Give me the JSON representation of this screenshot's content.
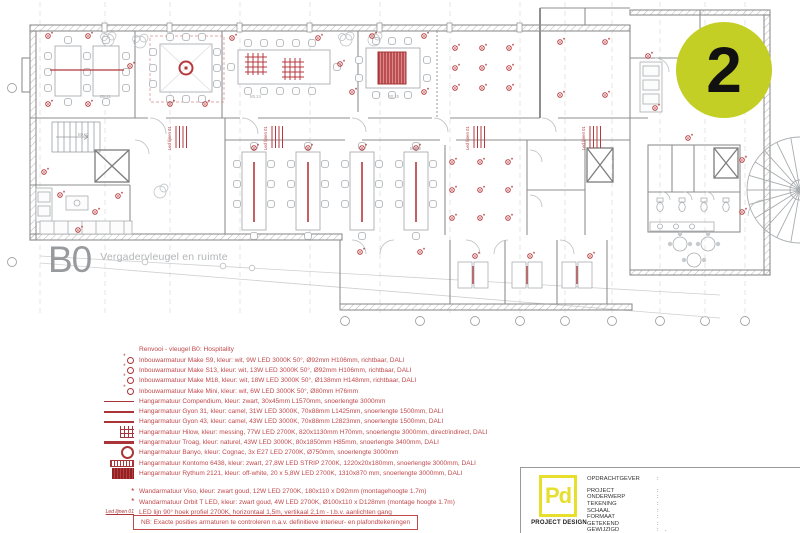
{
  "badge": {
    "number": "2"
  },
  "plan": {
    "sheet_code": "B0",
    "sheet_title": "Vergadervleugel en ruimte",
    "led_label": "Led lijnen 01",
    "room_labels": [
      "B0.21",
      "B0.24",
      "B0.25",
      "B0.13",
      "B0.30",
      "B0.02"
    ]
  },
  "legend": {
    "header": "Renvooi - vleugel B0: Hospitality",
    "items": [
      {
        "icon": "downlight-marker",
        "text": "Inbouwarmatuur Make S9, kleur: wit, 9W LED 3000K 50°, Ø92mm H106mm, richtbaar, DALI"
      },
      {
        "icon": "downlight-marker",
        "text": "Inbouwarmatuur Make S13, kleur: wit, 13W LED 3000K 50°, Ø92mm H106mm, richtbaar, DALI"
      },
      {
        "icon": "downlight-marker",
        "text": "Inbouwarmatuur Make M18, kleur: wit, 18W LED 3000K 50°, Ø138mm H148mm, richtbaar, DALI"
      },
      {
        "icon": "downlight-marker",
        "text": "Inbouwarmatuur Make Mini, kleur: wit, 6W LED 3000K 50°, Ø80mm H76mm"
      },
      {
        "icon": "pendant-line-thin",
        "text": "Hangarmatuur Compendium, kleur: zwart, 30x45mm L1570mm, snoerlengte 3000mm"
      },
      {
        "icon": "pendant-line-medium",
        "text": "Hangarmatuur Gyon 31, kleur: camel, 31W LED 3000K, 70x88mm L1425mm, snoerlengte 1500mm, DALI"
      },
      {
        "icon": "pendant-line-medium",
        "text": "Hangarmatuur Gyon 43, kleur: camel, 43W LED 3000K, 70x88mm L2823mm, snoerlengte 1500mm, DALI"
      },
      {
        "icon": "grid-hash",
        "text": "Hangarmatuur Hilow, kleur: messing, 77W LED 2700K, 820x1130mm H70mm, snoerlengte 3000mm, direct/indirect, DALI"
      },
      {
        "icon": "pendant-line-thick",
        "text": "Hangarmatuur Troag, kleur: naturel, 43W LED 3000K, 80x1850mm H85mm, snoerlengte 3400mm, DALI"
      },
      {
        "icon": "ring",
        "text": "Hangarmatuur Banyo, kleur: Cognac, 3x E27 LED 2700K, Ø750mm, snoerlengte 3000mm"
      },
      {
        "icon": "striped-bar",
        "text": "Hangarmatuur Kontomo 6438, kleur: zwart, 27,8W LED STRIP 2700K, 1220x20x180mm, snoerlengte 3000mm, DALI"
      },
      {
        "icon": "dense-striped-block",
        "text": "Hangarmatuur Rythum 2121, kleur: off-white, 20 x 5,8W LED 2700K, 1310x870 mm, snoerlengte 3000mm, DALI"
      },
      {
        "icon": "asterisk",
        "text": "Wandarmatuur Viso, kleur: zwart goud, 12W LED 2700K, 180x110 x D92mm (montagehoogte 1.7m)",
        "group": "wall"
      },
      {
        "icon": "asterisk",
        "text": "Wandarmatuur Orbit T LED, kleur: zwart goud, 4W LED 2700K, Ø100x110 x D128mm (montage hoogte 1.7m)",
        "group": "wall"
      },
      {
        "icon": "led-line-label",
        "text": "LED lijn 90° hoek profiel 2700K, horizontaal 1,5m, vertikaal 2,1m - t.b.v. aanlichten gang",
        "group": "wall"
      }
    ],
    "note": "NB: Exacte posities armaturen te controleren n.a.v. definitieve interieur- en plafondtekeningen"
  },
  "titleblock": {
    "logo_text": "Pd",
    "company": "PROJECT DESIGN",
    "fields": [
      {
        "label": "OPDRACHTGEVER",
        "value": ""
      },
      {
        "label": "PROJECT",
        "value": ""
      },
      {
        "label": "ONDERWERP",
        "value": ""
      },
      {
        "label": "TEKENING",
        "value": ""
      },
      {
        "label": "SCHAAL",
        "value": ""
      },
      {
        "label": "FORMAAT",
        "value": ""
      },
      {
        "label": "GETEKEND",
        "value": ""
      },
      {
        "label": "GEWIJZIGD",
        "value": "."
      }
    ]
  },
  "colors": {
    "annotation_red": "#c1494c",
    "annotation_red_dark": "#a93539",
    "badge_yellow": "#c3cf25",
    "logo_yellow": "#e6df2e"
  }
}
